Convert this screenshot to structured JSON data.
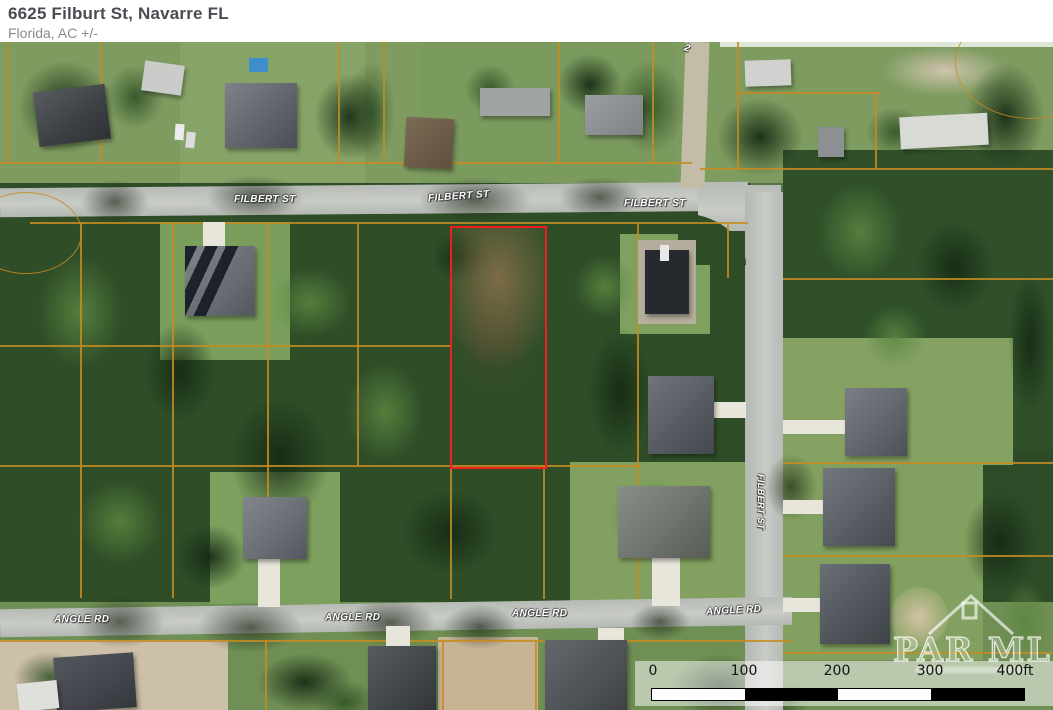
{
  "header": {
    "title": "6625 Filburt St, Navarre FL",
    "subtitle": "Florida,  AC +/-"
  },
  "map": {
    "street_labels": [
      {
        "text": "FILBERT ST"
      },
      {
        "text": "FILBERT ST"
      },
      {
        "text": "FILBERT ST"
      },
      {
        "text": "FILBERT ST"
      },
      {
        "text": "ANGLE RD"
      },
      {
        "text": "ANGLE RD"
      },
      {
        "text": "ANGLE RD"
      },
      {
        "text": "ANGLE RD"
      }
    ],
    "partial_label": "2",
    "scale_bar": {
      "ticks": [
        "0",
        "100",
        "200",
        "300"
      ],
      "end_label": "400ft"
    },
    "watermark": {
      "text": "PAR MLS"
    },
    "colors": {
      "property_outline": "#f21d1d",
      "parcel_line": "#c58c22",
      "road": "#c1c5bf",
      "forest": "#2f4e28"
    }
  }
}
